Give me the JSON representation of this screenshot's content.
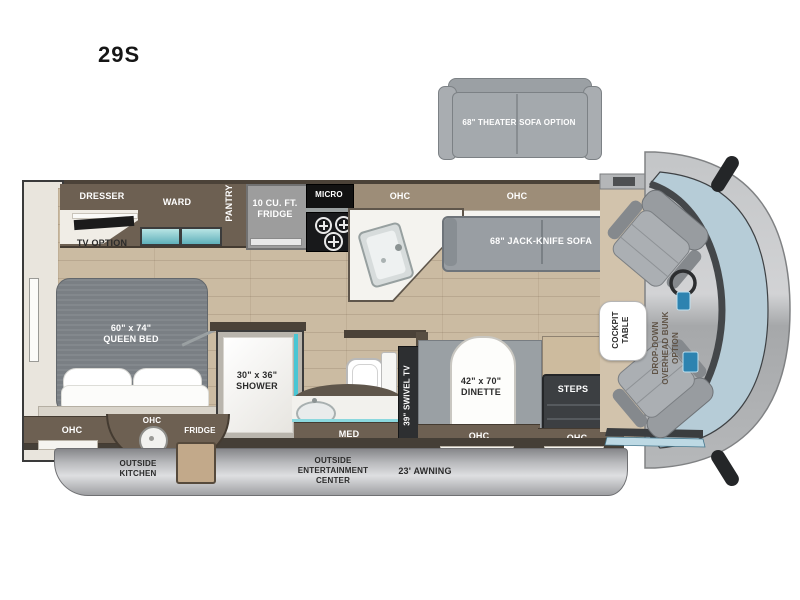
{
  "title": "29S",
  "colors": {
    "floor_wood": "#cbbba2",
    "cabinet_dark_wood": "#6d6052",
    "overhead_cabinet": "#9d8d78",
    "sofa_gray": "#9aa0a5",
    "bed_gray": "#7a7f84",
    "teal_accent": "#49c6d4",
    "windshield_blue": "#b6ccd7",
    "awning_gray": "#b9babd",
    "wall_dark": "#4b4238"
  },
  "labels": {
    "theater_sofa_option": "68\" THEATER SOFA OPTION",
    "dresser": "DRESSER",
    "ward": "WARD",
    "pantry": "PANTRY",
    "tv_option": "TV OPTION",
    "fridge_10cuft": "10 CU. FT.\nFRIDGE",
    "micro": "MICRO",
    "ohc": "OHC",
    "jack_knife_sofa": "68\" JACK-KNIFE SOFA",
    "queen_bed": "60\" x 74\"\nQUEEN BED",
    "shower": "30\" x 36\"\nSHOWER",
    "med": "MED",
    "swivel_tv": "39\" SWIVEL TV",
    "dinette": "42\" x 70\"\nDINETTE",
    "steps": "STEPS",
    "cockpit_table": "COCKPIT\nTABLE",
    "drop_down_bunk": "DROP-DOWN\nOVERHEAD BUNK\nOPTION",
    "outside_kitchen": "OUTSIDE\nKITCHEN",
    "outside_entertainment_center": "OUTSIDE\nENTERTAINMENT\nCENTER",
    "awning": "23' AWNING",
    "fridge_outside": "FRIDGE"
  }
}
